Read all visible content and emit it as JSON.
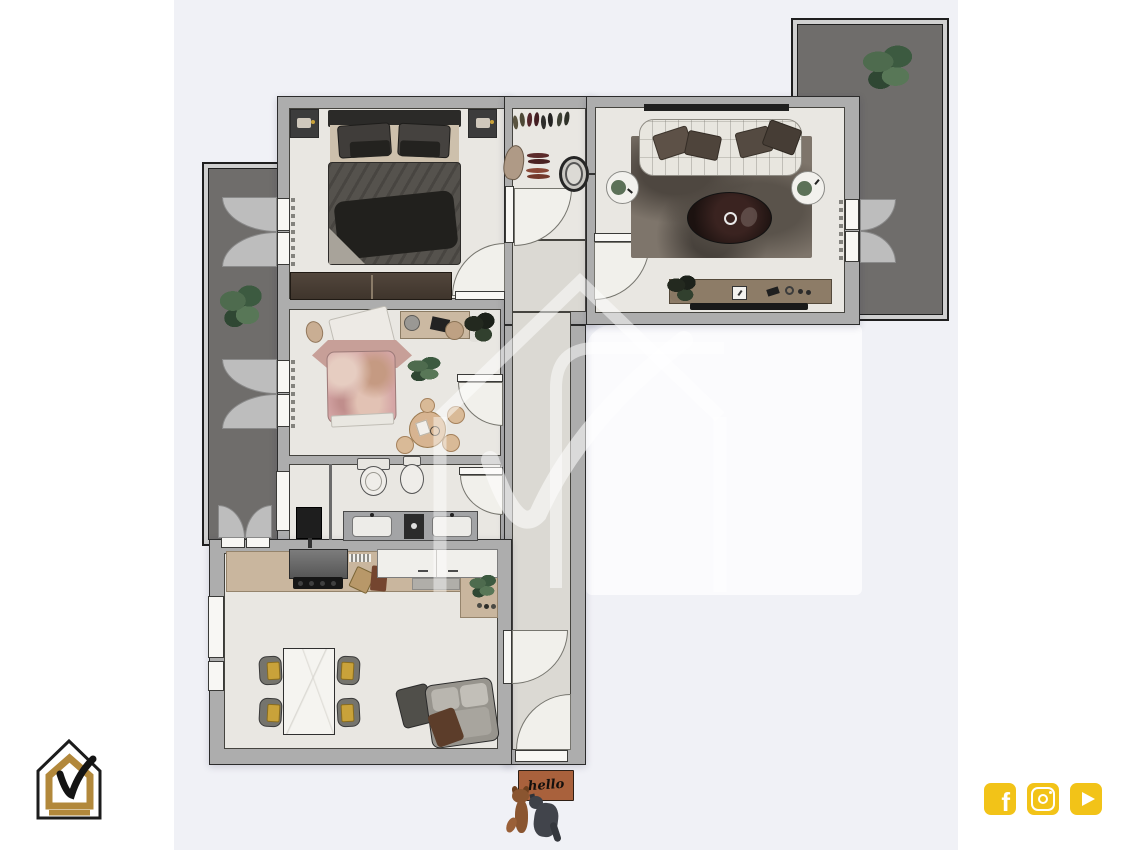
{
  "doormat": {
    "text": "hello"
  },
  "brand": {
    "logo_name": "house-check-logo"
  },
  "watermark": {
    "name": "house-check-watermark"
  },
  "social_icons": [
    {
      "name": "facebook-icon"
    },
    {
      "name": "instagram-icon"
    },
    {
      "name": "youtube-icon"
    }
  ],
  "scene": {
    "type": "apartment-floor-plan-3d-top-view",
    "rooms": [
      "master-bedroom",
      "entry-hall",
      "living-room",
      "second-bedroom",
      "bathroom",
      "kitchen-dining",
      "corridor",
      "balcony-left",
      "terrace-right"
    ]
  },
  "colors": {
    "page_bg": "#FFFFFF",
    "panel_bg": "#F0F1F6",
    "wall_fill": "#ADADAD",
    "wall_line": "#2B2B2B",
    "floor": "#E9E7E2",
    "floor_dim": "#DBD9D3",
    "balcony_floor": "#6F6D6B",
    "balcony_rim": "#D0D0D0",
    "white_area": "#FBFBFD",
    "arc_fill": "#F1F0EB",
    "leaf_fill": "#F8F7F4",
    "curtain_fill": "#BDBDBD",
    "logo_gold": "#B2883B",
    "logo_black": "#1C1C1C",
    "social_yellow": "#F2C318",
    "mat_brown": "#A9613C",
    "rug_brown": "#7E756B",
    "sofa_white": "#E8E6DF",
    "wood_dark": "#463A31",
    "counter_tan": "#C9B69E",
    "duvet_gray": "#55524D",
    "pink_bed": "#D5A6A6",
    "seat_gold": "#C9A23A"
  }
}
